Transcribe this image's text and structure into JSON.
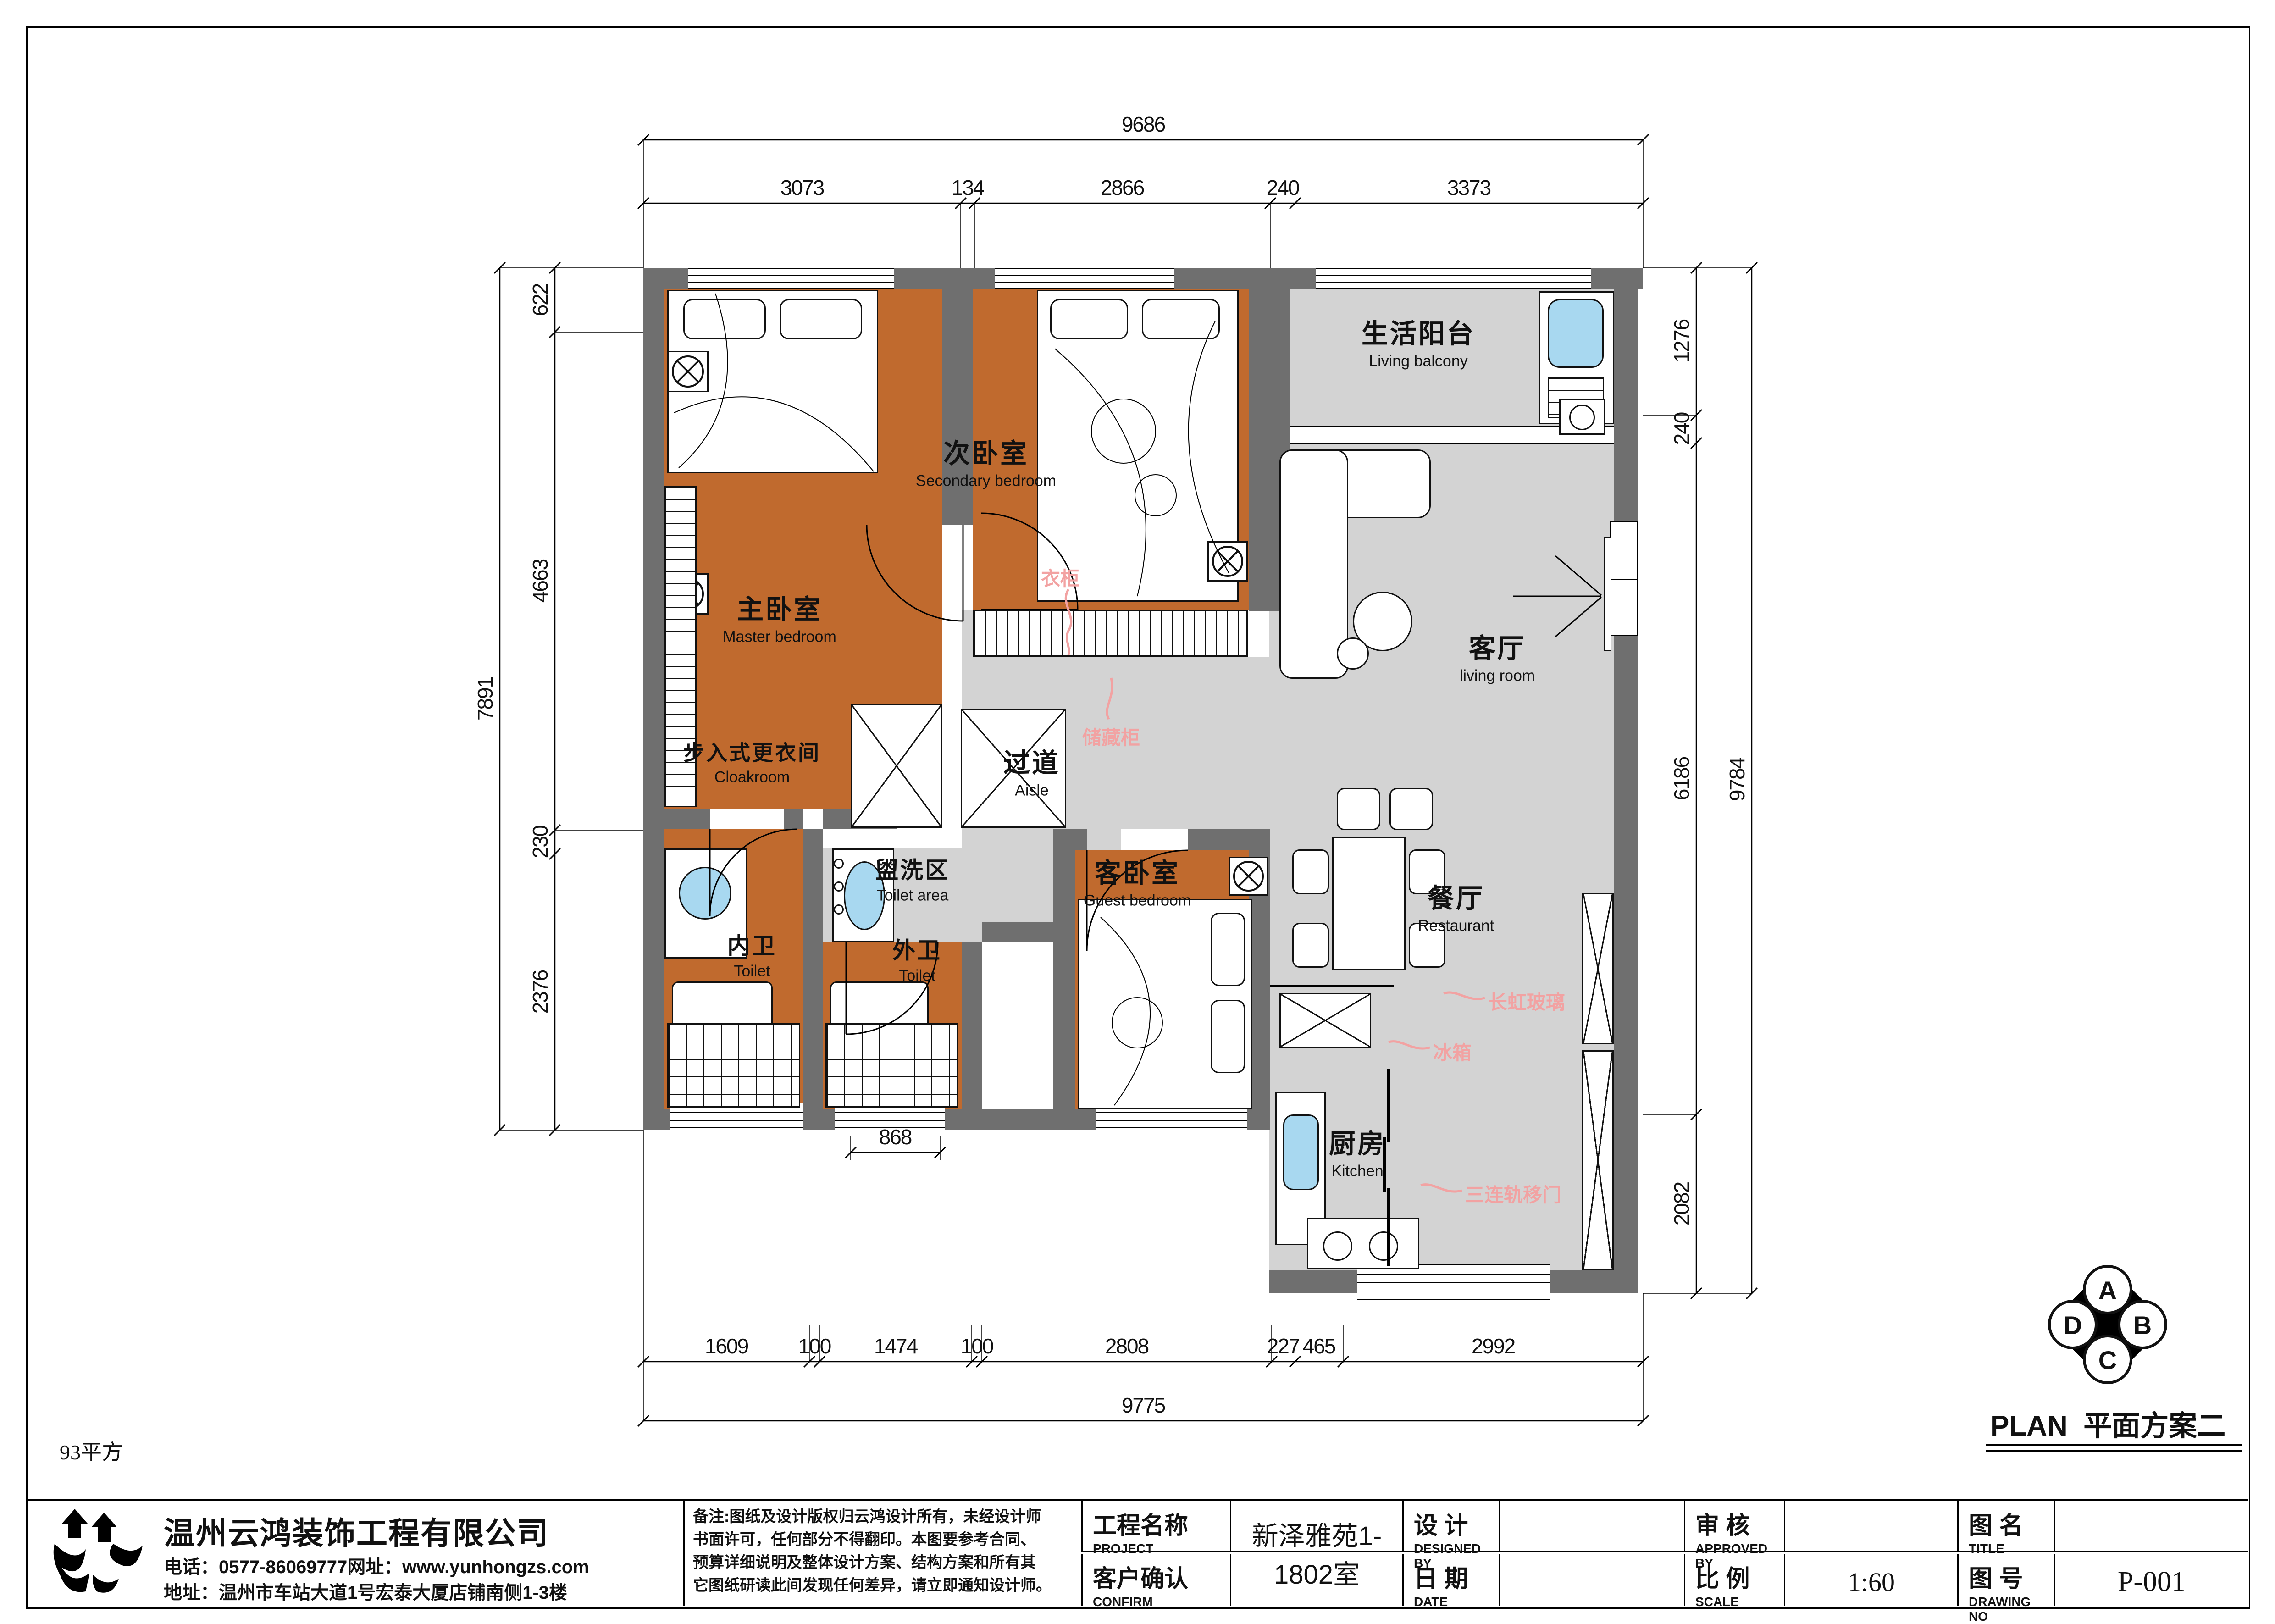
{
  "sheet": {
    "area_note": "93平方",
    "plan_title_en": "PLAN",
    "plan_title_cn": "平面方案二"
  },
  "company": {
    "name": "温州云鸿装饰工程有限公司",
    "phone_line": "电话：0577-86069777网址：www.yunhongzs.com",
    "address_line": "地址：温州市车站大道1号宏泰大厦店铺南侧1-3楼"
  },
  "notes": {
    "line1": "备注:图纸及设计版权归云鸿设计所有，未经设计师",
    "line2": "书面许可，任何部分不得翻印。本图要参考合同、",
    "line3": "预算详细说明及整体设计方案、结构方案和所有其",
    "line4": "它图纸研读此间发现任何差异，请立即通知设计师。"
  },
  "title_block": {
    "project_label_cn": "工程名称",
    "project_label_en": "PROJECT",
    "project_value": "新泽雅苑1-1802室",
    "confirm_label_cn": "客户确认",
    "confirm_label_en": "CONFIRM",
    "confirm_value": "",
    "designed_label_cn": "设  计",
    "designed_label_en": "DESIGNED BY",
    "designed_value": "",
    "date_label_cn": "日  期",
    "date_label_en": "DATE",
    "date_value": "",
    "approved_label_cn": "审  核",
    "approved_label_en": "APPROVED BY",
    "approved_value": "",
    "scale_label_cn": "比  例",
    "scale_label_en": "SCALE",
    "scale_value": "1:60",
    "title_label_cn": "图  名",
    "title_label_en": "TITLE",
    "title_value": "",
    "drawing_label_cn": "图  号",
    "drawing_label_en": "DRAWING NO",
    "drawing_value": "P-001"
  },
  "compass": {
    "top": "A",
    "right": "B",
    "bottom": "C",
    "left": "D"
  },
  "rooms": {
    "balcony": {
      "cn": "生活阳台",
      "en": "Living balcony"
    },
    "secondary": {
      "cn": "次卧室",
      "en": "Secondary bedroom"
    },
    "master": {
      "cn": "主卧室",
      "en": "Master bedroom"
    },
    "living": {
      "cn": "客厅",
      "en": "living room"
    },
    "cloakroom": {
      "cn": "步入式更衣间",
      "en": "Cloakroom"
    },
    "aisle": {
      "cn": "过道",
      "en": "Aisle"
    },
    "toilet_area": {
      "cn": "盥洗区",
      "en": "Toilet area"
    },
    "guest": {
      "cn": "客卧室",
      "en": "Guest bedroom"
    },
    "inner_toilet": {
      "cn": "内卫",
      "en": "Toilet"
    },
    "outer_toilet": {
      "cn": "外卫",
      "en": "Toilet"
    },
    "restaurant": {
      "cn": "餐厅",
      "en": "Restaurant"
    },
    "kitchen": {
      "cn": "厨房",
      "en": "Kitchen"
    }
  },
  "annotations": {
    "wardrobe": "衣柜",
    "storage": "储藏柜",
    "glass": "长虹玻璃",
    "fridge": "冰箱",
    "sliding_door": "三连轨移门"
  },
  "dimensions": {
    "top_total": "9686",
    "top_segments": [
      "3073",
      "134",
      "2866",
      "240",
      "3373"
    ],
    "left_outer": "7891",
    "left_segments": [
      "622",
      "4663",
      "230",
      "2376"
    ],
    "right_outer": "9784",
    "right_segments": [
      "1276",
      "240",
      "6186",
      "2082"
    ],
    "bottom_total": "9775",
    "bottom_segments": [
      "1609",
      "100",
      "1474",
      "100",
      "2808",
      "227",
      "465",
      "2992"
    ],
    "window_dim": "868"
  },
  "colors": {
    "bedroom_floor": "#c06a2e",
    "public_floor": "#d3d3d3",
    "wall": "#6f6f6f",
    "annotation": "#f2a2a2",
    "fixture_blue": "#a8d8f0"
  }
}
